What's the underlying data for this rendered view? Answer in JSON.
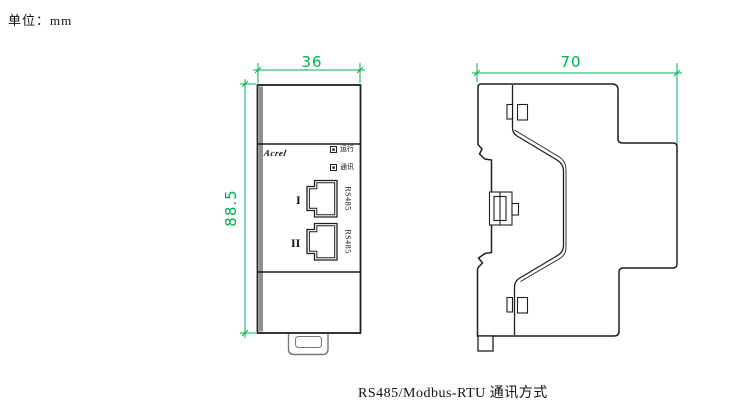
{
  "meta": {
    "unit_label": "单位：mm",
    "caption": "RS485/Modbus-RTU 通讯方式"
  },
  "colors": {
    "dimension_green": "#00b050",
    "outline_black": "#1f1f1f",
    "shade_gray": "#8f8f8f",
    "background": "#ffffff"
  },
  "front_view": {
    "title": "front-view",
    "width_dim": "36",
    "height_dim": "88.5",
    "brand_logo": "Acrel",
    "indicators": [
      {
        "label": "运行"
      },
      {
        "label": "通讯"
      }
    ],
    "ports": [
      {
        "index": "I",
        "label": "RS485"
      },
      {
        "index": "II",
        "label": "RS485"
      }
    ]
  },
  "side_view": {
    "title": "side-view",
    "depth_dim": "70"
  }
}
